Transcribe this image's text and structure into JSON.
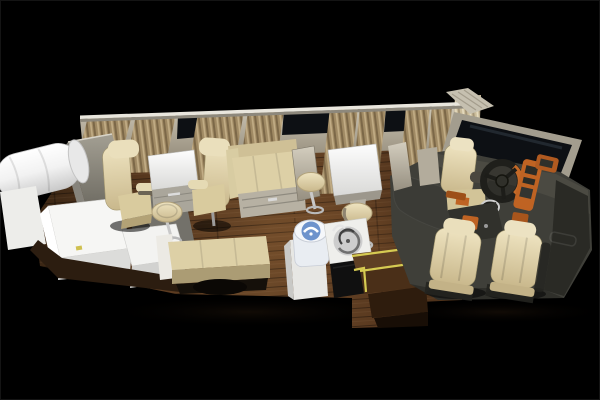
{
  "scene": {
    "type": "3d-render",
    "title": "Top-down cutaway 3D rendering of a luxury motorhome bus interior with lounge seats, bar, galley and driver cockpit",
    "background": "#000000",
    "objects": [
      {
        "name": "curtain-panels",
        "color": "#a08a64"
      },
      {
        "name": "window-rail",
        "color": "#e9e6dd"
      },
      {
        "name": "side-windows",
        "color": "#0d1014"
      },
      {
        "name": "rear-bedding-roll",
        "color": "#f5f5f5"
      },
      {
        "name": "rear-sideboard",
        "color": "#9b978c"
      },
      {
        "name": "wardrobe-cabinets",
        "count": 2,
        "color": "#f2f2f2"
      },
      {
        "name": "captain-chairs",
        "count": 2,
        "color": "#ddd0a6"
      },
      {
        "name": "lounge-table",
        "color": "#f5f5f3"
      },
      {
        "name": "chaise-sofa",
        "color": "#e2d7ae"
      },
      {
        "name": "storage-bench",
        "color": "#ddd0a6"
      },
      {
        "name": "wheel-arch",
        "color": "#0b0805"
      },
      {
        "name": "bar-stools",
        "count": 3,
        "color": "#ddd0a6"
      },
      {
        "name": "bar-table",
        "color": "#f5f5f3"
      },
      {
        "name": "water-dispenser",
        "color": "#6e93cc"
      },
      {
        "name": "kitchen-sink",
        "color": "#cdcdcd"
      },
      {
        "name": "entry-steps",
        "trim": "#d6cb52"
      },
      {
        "name": "partition-walls",
        "color": "#cfc9ba"
      },
      {
        "name": "driver-platform",
        "color": "#3f3f39"
      },
      {
        "name": "dashboard-wood-trim",
        "color": "#bf6323"
      },
      {
        "name": "steering-wheel",
        "color": "#21211d"
      },
      {
        "name": "windshield",
        "color": "#0d1014"
      },
      {
        "name": "jump-seat",
        "color": "#ddd0a6"
      },
      {
        "name": "front-seats",
        "count": 2,
        "color": "#ddd0a6"
      },
      {
        "name": "wood-floor",
        "color": "#5a3a20"
      }
    ]
  },
  "palette": {
    "background": "#000000",
    "rail_white": "#e9e6dd",
    "wall_beige": "#b8b19f",
    "curtain_tan": "#a08a64",
    "window_glass": "#0d1014",
    "seat_cream": "#ddd0a6",
    "seat_cream_light": "#eadfbc",
    "cabinet_white": "#f6f6f4",
    "platform_gray": "#3f3f39",
    "ledge_charcoal": "#3b3b36",
    "dash_trim_orange": "#bf6323",
    "step_trim_yellow": "#d6cb52",
    "dispenser_blue": "#6e93cc",
    "sink_steel": "#cdcdcd",
    "base_wood_brown": "#2c1d10",
    "wood_floor": "#5a3a20"
  }
}
